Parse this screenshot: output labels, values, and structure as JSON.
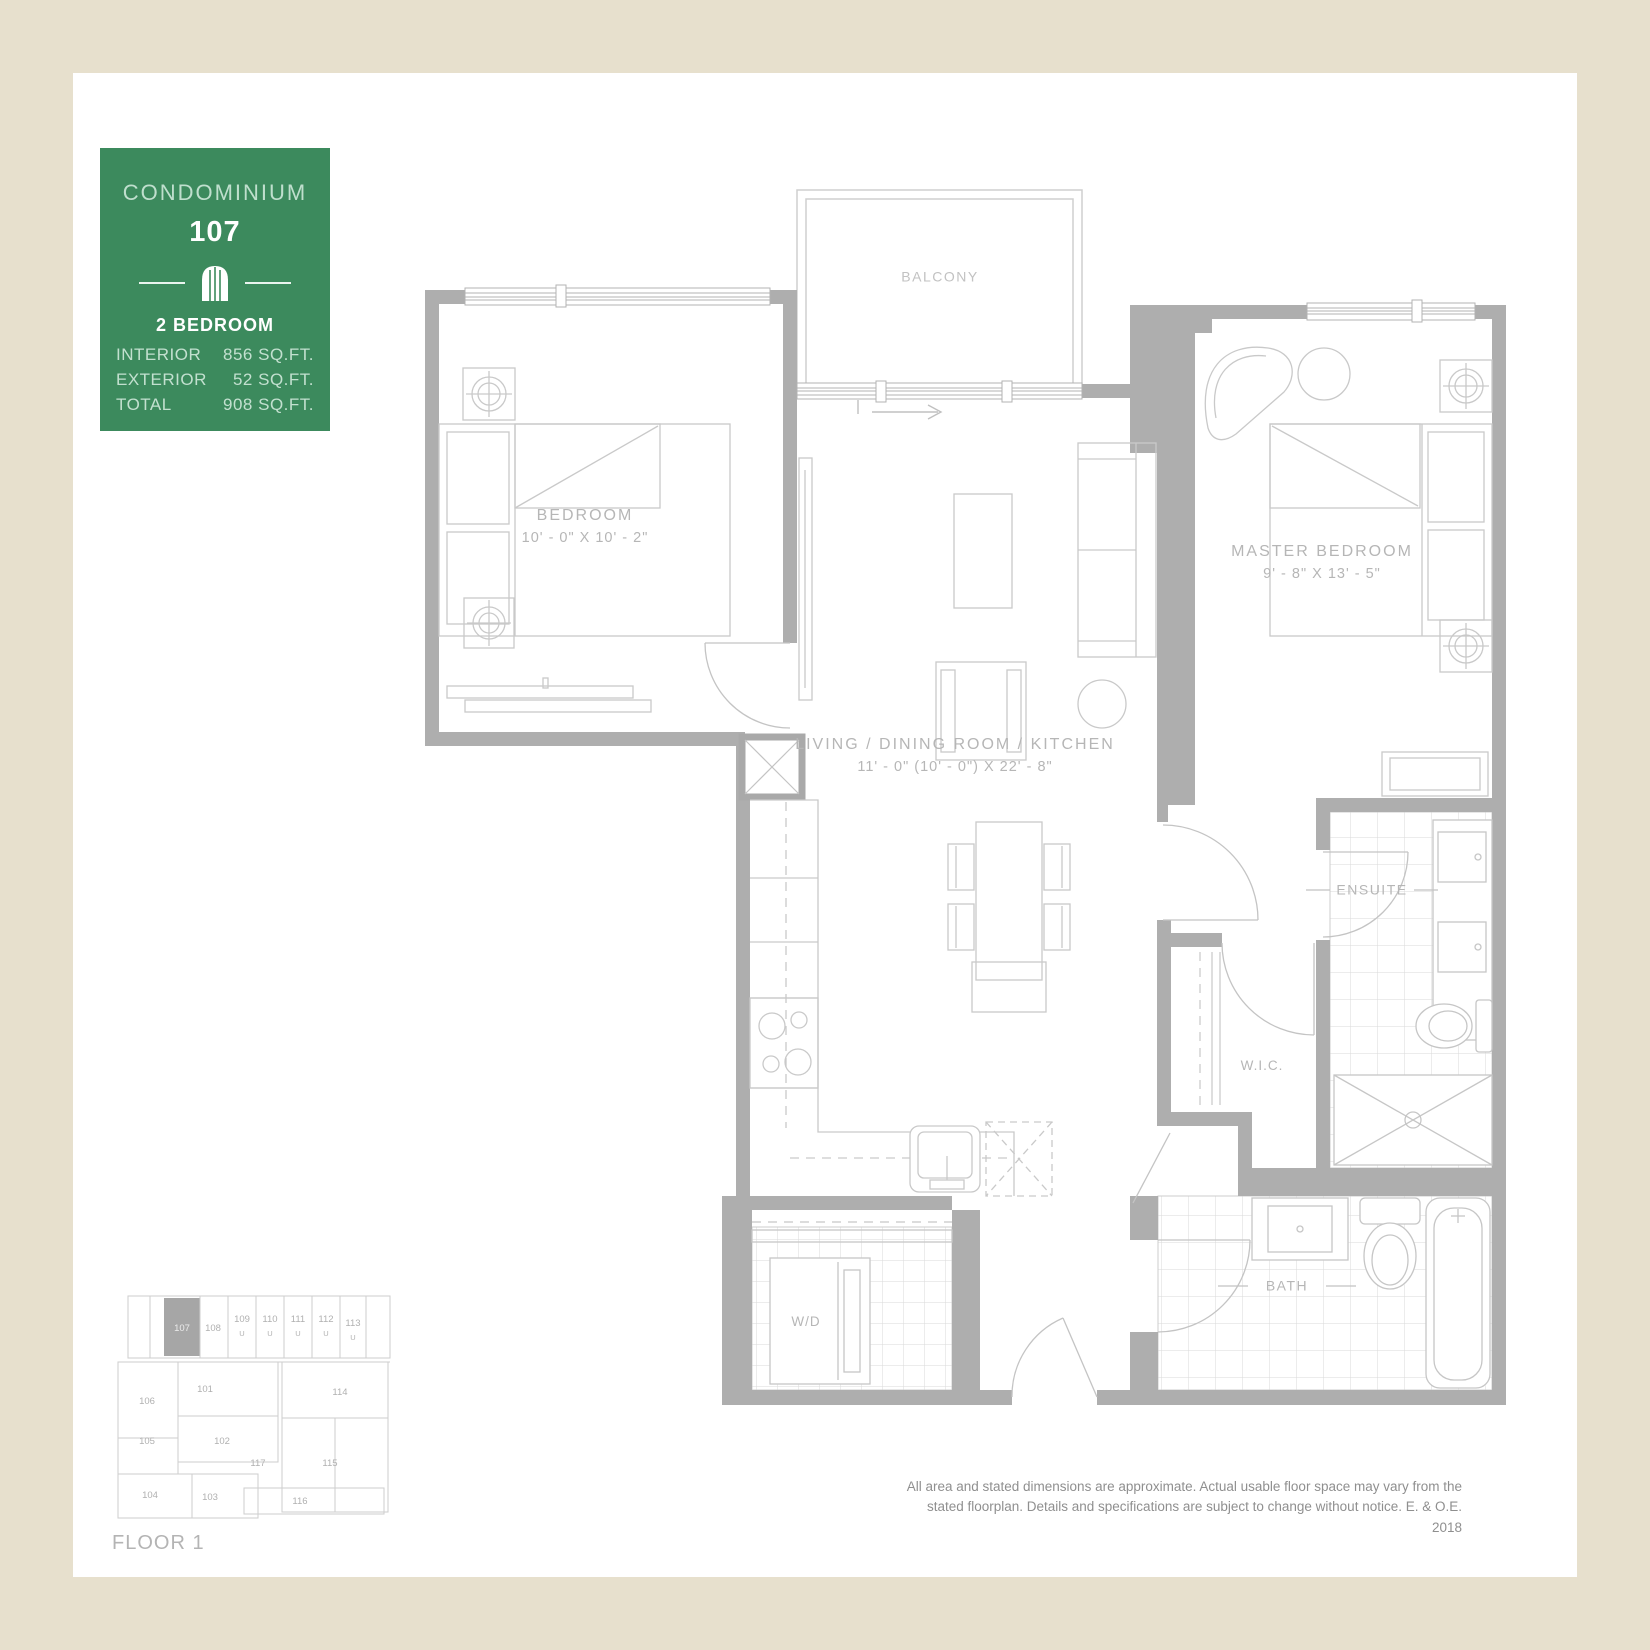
{
  "colors": {
    "canvas": "#e7e0cd",
    "surface": "#ffffff",
    "card_green": "#3c8a5d",
    "wall_gray": "#aeaeae",
    "line_gray": "#c9c9c9",
    "label_gray": "#b6b6b6"
  },
  "info_card": {
    "title": "CONDOMINIUM",
    "unit_number": "107",
    "icon": "arched-window-icon",
    "type_label": "2 BEDROOM",
    "stats": [
      {
        "label": "INTERIOR",
        "value": "856 SQ.FT."
      },
      {
        "label": "EXTERIOR",
        "value": "52 SQ.FT."
      },
      {
        "label": "TOTAL",
        "value": "908 SQ.FT."
      }
    ]
  },
  "floorplan": {
    "rooms": {
      "balcony": {
        "name": "BALCONY"
      },
      "bedroom": {
        "name": "BEDROOM",
        "dimensions": "10' - 0\" X 10' - 2\""
      },
      "master_bedroom": {
        "name": "MASTER BEDROOM",
        "dimensions": "9' - 8\" X 13' - 5\""
      },
      "living": {
        "name": "LIVING / DINING ROOM / KITCHEN",
        "dimensions": "11' - 0\" (10' - 0\") X 22' - 8\""
      },
      "ensuite": {
        "name": "ENSUITE"
      },
      "wic": {
        "name": "W.I.C."
      },
      "bath": {
        "name": "BATH"
      },
      "laundry": {
        "name": "W/D"
      }
    }
  },
  "keyplan": {
    "floor_label": "FLOOR 1",
    "highlighted_unit": "107",
    "u_mark": "U",
    "units": [
      "107",
      "108",
      "109",
      "110",
      "111",
      "112",
      "113",
      "101",
      "114",
      "106",
      "105",
      "102",
      "117",
      "115",
      "104",
      "103",
      "116"
    ]
  },
  "disclaimer": {
    "line1": "All area and stated dimensions are approximate. Actual usable floor space may vary from the",
    "line2": "stated floorplan. Details and specifications are subject to change without notice. E. & O.E. 2018"
  }
}
